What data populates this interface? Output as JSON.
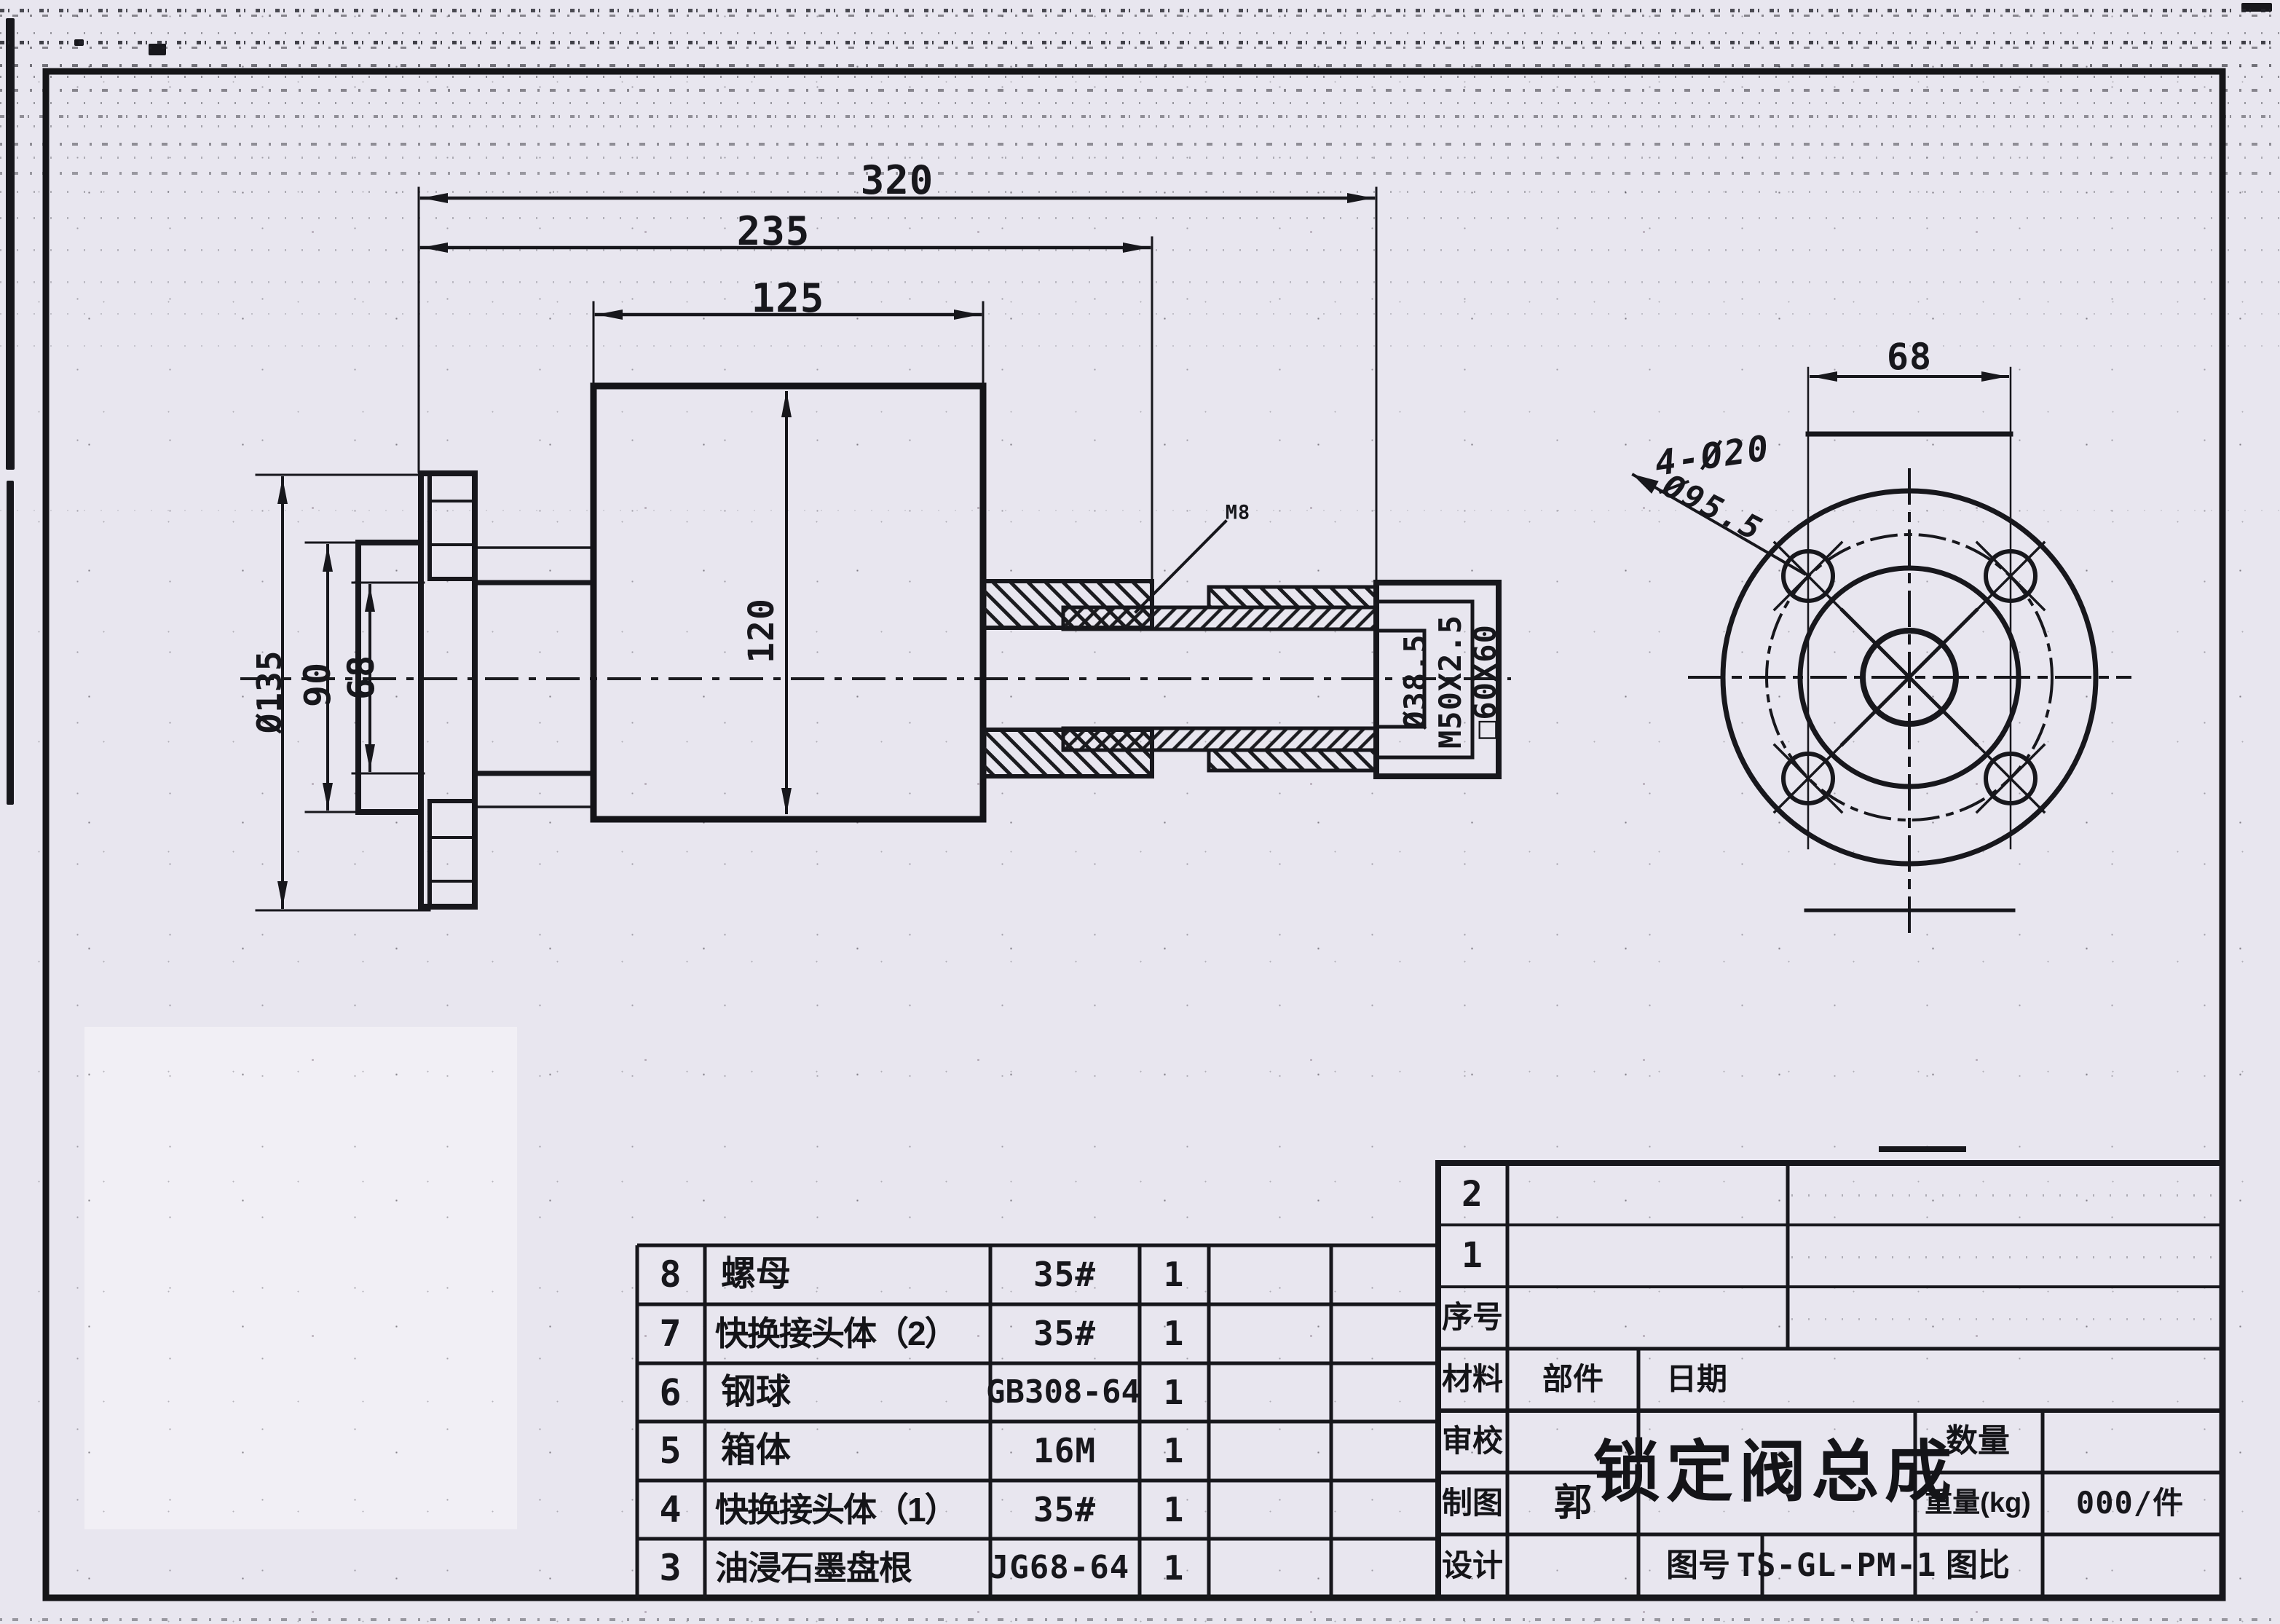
{
  "drawing": {
    "dims": {
      "overall_length": "320",
      "body_to_joint": "235",
      "body_width": "125",
      "body_height": "120",
      "flange_od": "Ø135",
      "hub_od": "90",
      "bore": "68",
      "gland_bore": "Ø38.5",
      "thread": "M50X2.5",
      "nut_square": "□60X60",
      "weld_note": "M8",
      "flange_hole_note": "4-Ø20",
      "bolt_circle": "Ø95.5",
      "flange_hole_span": "68"
    }
  },
  "parts_table": {
    "rows": [
      {
        "no": "8",
        "name": "螺母",
        "spec": "35#",
        "qty": "1"
      },
      {
        "no": "7",
        "name": "快换接头体（2）",
        "spec": "35#",
        "qty": "1"
      },
      {
        "no": "6",
        "name": "钢球",
        "spec": "GB308-64",
        "qty": "1"
      },
      {
        "no": "5",
        "name": "箱体",
        "spec": "16M",
        "qty": "1"
      },
      {
        "no": "4",
        "name": "快换接头体（1）",
        "spec": "35#",
        "qty": "1"
      },
      {
        "no": "3",
        "name": "油浸石墨盘根",
        "spec": "JG68-64",
        "qty": "1"
      }
    ]
  },
  "title_block": {
    "row2": "2",
    "row1": "1",
    "seq_label": "序号",
    "material_label": "材料",
    "part_label": "部件",
    "date_label": "日期",
    "review_label": "审校",
    "draft_label": "制图",
    "draft_by": "郭",
    "design_label": "设计",
    "title": "锁定阀总成",
    "qty_label": "数量",
    "weight_label": "重量(kg)",
    "weight_value": "000/件",
    "drawing_no_label": "图号",
    "drawing_no": "TS-GL-PM-1",
    "scale_label": "图比"
  }
}
